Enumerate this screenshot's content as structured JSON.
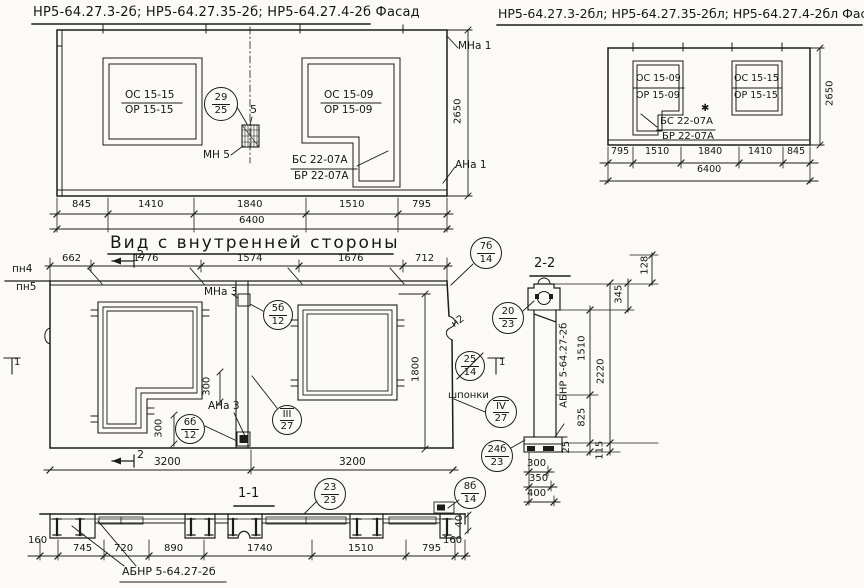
{
  "facade_inner": {
    "title": "НР5-64.27.3-2б; НР5-64.27.35-2б; НР5-64.27.4-2б  Фасад",
    "window_left": {
      "top": "ОС 15-15",
      "bottom": "ОР 15-15"
    },
    "window_right": {
      "top": "ОС 15-09",
      "bottom": "ОР 15-09"
    },
    "balcony": {
      "top": "БС 22-07А",
      "bottom": "БР 22-07А"
    },
    "callout_29": {
      "top": "29",
      "bottom": "25"
    },
    "detail_5": "5",
    "mn5": "МН 5",
    "mna1": "МНа 1",
    "ana1": "АНа 1",
    "height": "2650",
    "dims": [
      "845",
      "1410",
      "1840",
      "1510",
      "795"
    ],
    "total": "6400"
  },
  "facade_outer": {
    "title": "НР5-64.27.3-2бл; НР5-64.27.35-2бл; НР5-64.27.4-2бл  Фасад",
    "window_left": {
      "top": "ОС 15-09",
      "bottom": "ОР 15-09"
    },
    "window_right": {
      "top": "ОС 15-15",
      "bottom": "ОР 15-15"
    },
    "balcony": {
      "top": "БС 22-07А",
      "bottom": "БР 22-07А"
    },
    "asterisk": "✱",
    "height": "2650",
    "dims": [
      "795",
      "1510",
      "1840",
      "1410",
      "845"
    ],
    "total": "6400"
  },
  "inner_view": {
    "title": "Вид с внутренней стороны",
    "top_dims": [
      "662",
      "1776",
      "1574",
      "1676",
      "712"
    ],
    "pn4": "пн4",
    "pn5": "пн5",
    "section2": "2",
    "section1": "1",
    "mna3": "МНа 3",
    "ana3": "АНа 3",
    "n2": "н2",
    "shponki": "шпонки",
    "dim_1800": "1800",
    "dim_300_step": "300",
    "dim_300_leg": "300",
    "bottom_dims": [
      "3200",
      "3200"
    ],
    "callouts": {
      "c5b": {
        "top": "5б",
        "bottom": "12"
      },
      "c6b": {
        "top": "6б",
        "bottom": "12"
      },
      "c3": {
        "top": "III",
        "bottom": "27"
      },
      "c4": {
        "top": "IV",
        "bottom": "27"
      },
      "c20": {
        "top": "20",
        "bottom": "23"
      },
      "c25": {
        "top": "25",
        "bottom": "14"
      },
      "c24b": {
        "top": "24б",
        "bottom": "23"
      },
      "c8b": {
        "top": "8б",
        "bottom": "14"
      },
      "c7b": {
        "top": "7б",
        "bottom": "14"
      }
    }
  },
  "section_2_2": {
    "title": "2-2",
    "dim_128": "128",
    "dim_345": "345",
    "dim_1510": "1510",
    "dim_2220": "2220",
    "dim_825": "825",
    "dim_25": "25",
    "dim_115": "115",
    "bottom_dims": [
      "300",
      "350",
      "400"
    ],
    "label": "АБНР 5-64.27-2б"
  },
  "section_1_1": {
    "title": "1-1",
    "callout_23": {
      "top": "23",
      "bottom": "23"
    },
    "dim_160_left": "160",
    "dim_160_right": "160",
    "dim_40": "40",
    "dims": [
      "745",
      "720",
      "890",
      "1740",
      "1510",
      "795"
    ],
    "label": "АБНР 5-64.27-2б"
  }
}
